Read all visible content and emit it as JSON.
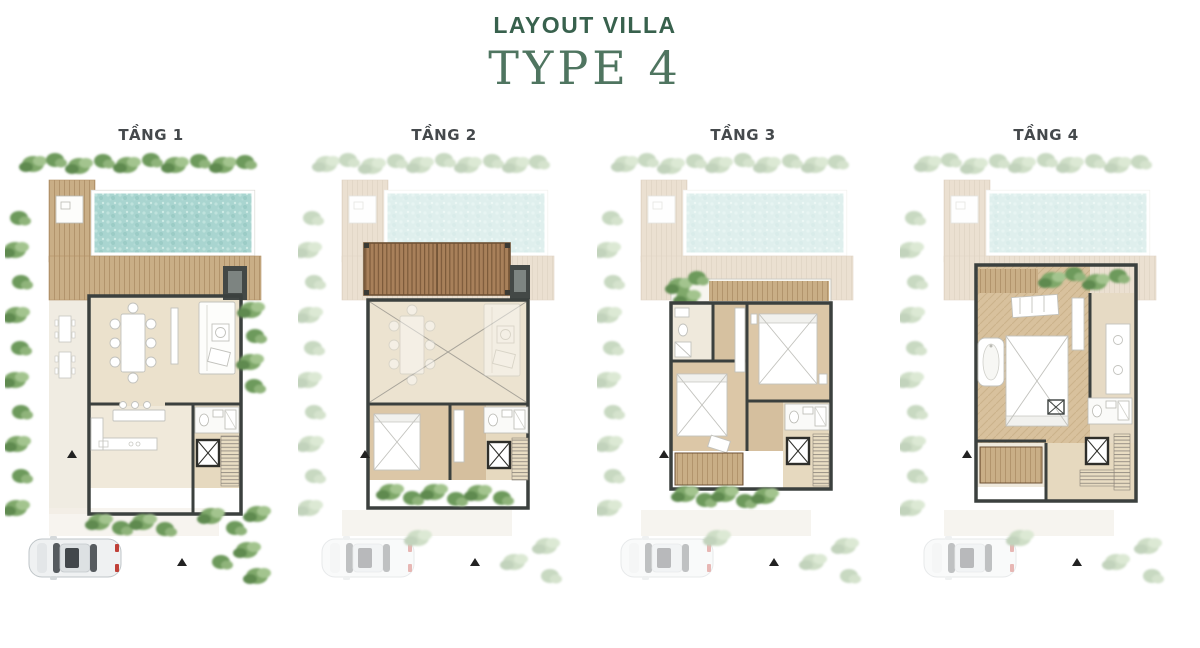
{
  "header": {
    "title": "LAYOUT VILLA",
    "subtitle": "TYPE 4"
  },
  "floors": [
    {
      "label": "TẦNG 1"
    },
    {
      "label": "TẦNG 2"
    },
    {
      "label": "TẦNG 3"
    },
    {
      "label": "TẦNG 4"
    }
  ],
  "palette": {
    "title_green": "#38614d",
    "subtitle_green": "#4f7560",
    "label_color": "#45494c",
    "pool_aqua": "#a9d5d0",
    "deck_wood": "#c9ae86",
    "pergola_wood": "#a8805a",
    "plant_green": "#6f9b5e",
    "wall_dark": "#3b403e",
    "interior_tile": "#ebe1cc",
    "interior_wood": "#dcc7a7",
    "car_body": "#eff1f2",
    "car_accent_red": "#c04038"
  }
}
